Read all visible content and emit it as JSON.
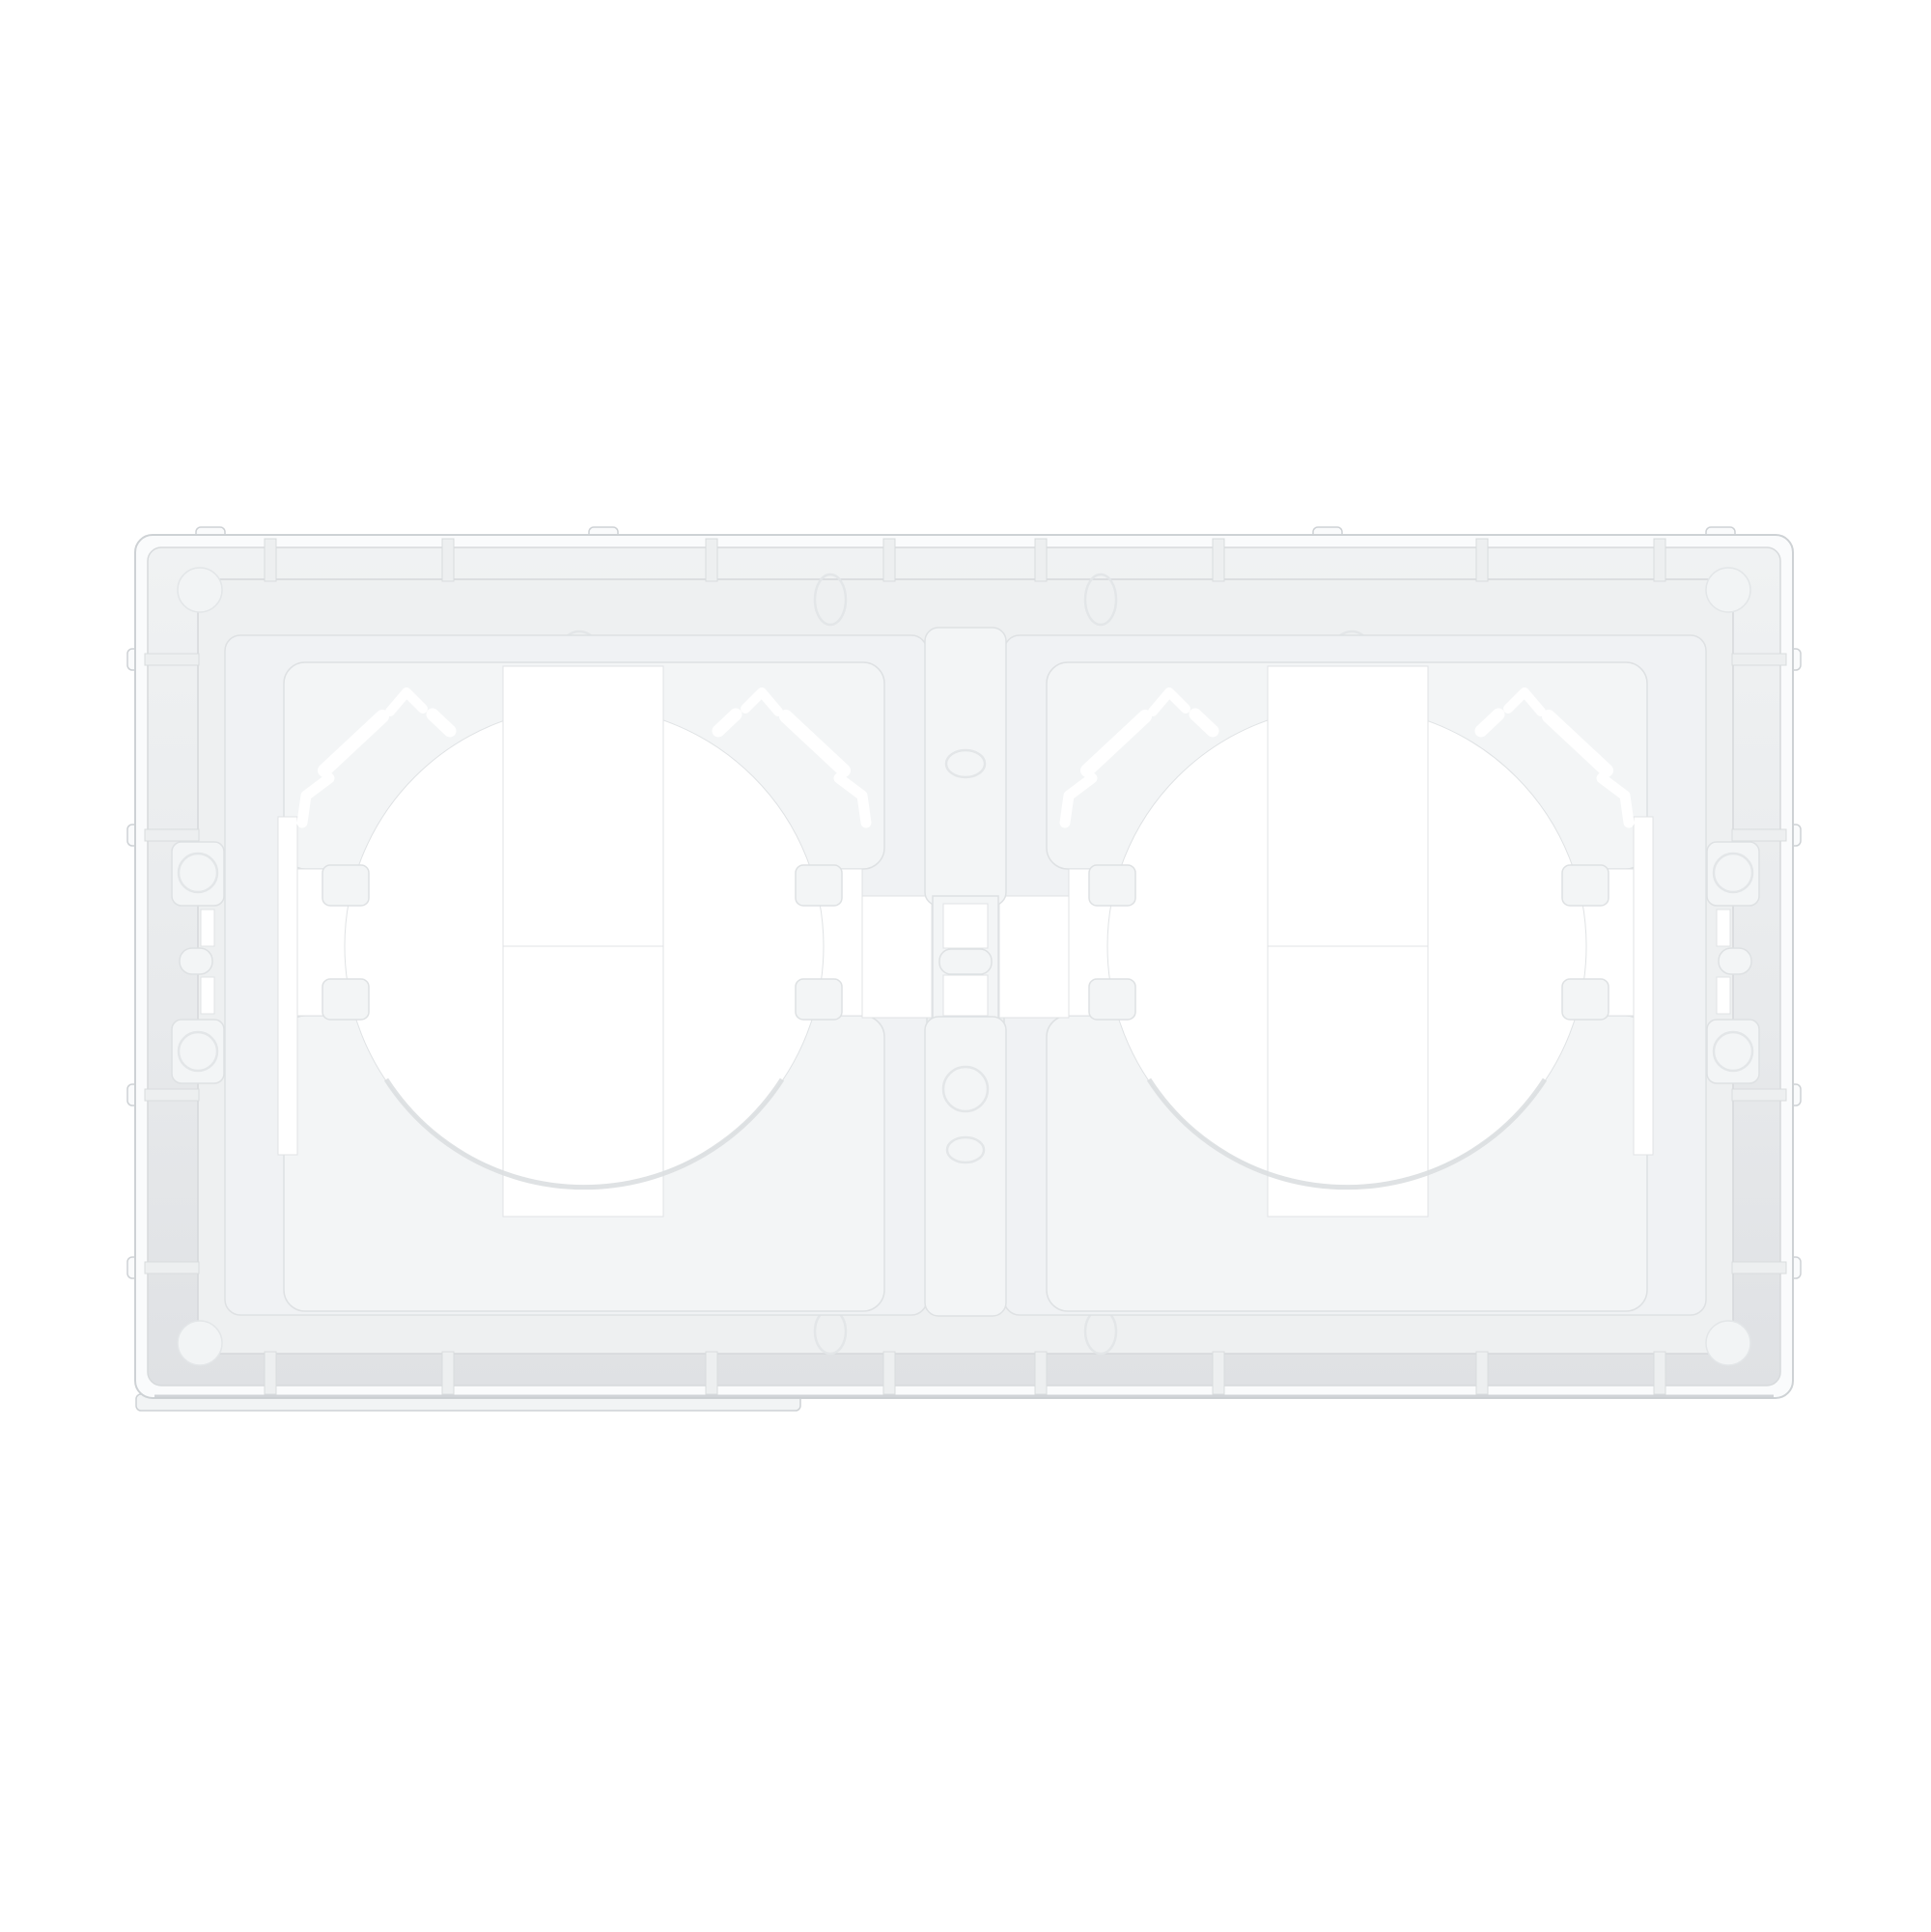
{
  "image_alt": "Rear view of a white plastic two-gang electrical wall plate frame on a white background: two square module bays with large circular openings, chevron-shaped spring slits in the upper corners, retaining hooks, a central connector strip with two rectangular holes and an oval stud, side clip pads and small mounting ribs along the perimeter wall.",
  "subject": {
    "object": "double wall plate frame, back side",
    "gang_count": 2,
    "material_color_name": "white",
    "background": "plain white"
  },
  "palette": {
    "bg": "#ffffff",
    "face": "#fafbfc",
    "face_line": "#ced2d5",
    "chan_top": "#f0f2f3",
    "chan_mid": "#e8eaec",
    "chan_bot": "#dfe1e4",
    "chan_line": "#d7dadc",
    "floor": "#eef0f1",
    "floor_line": "#d5d8db",
    "support": "#f0f2f4",
    "part": "#f3f5f6",
    "part_line": "#dee1e3",
    "rib": "#edeff0",
    "rib_line": "#d9dcde",
    "pad": "#f2f4f5",
    "impression": "#e3e6e8",
    "cut_line": "#e0e3e5",
    "shadow_arc": "#dcdfe1",
    "frame_bottom": "#c7cbce"
  }
}
